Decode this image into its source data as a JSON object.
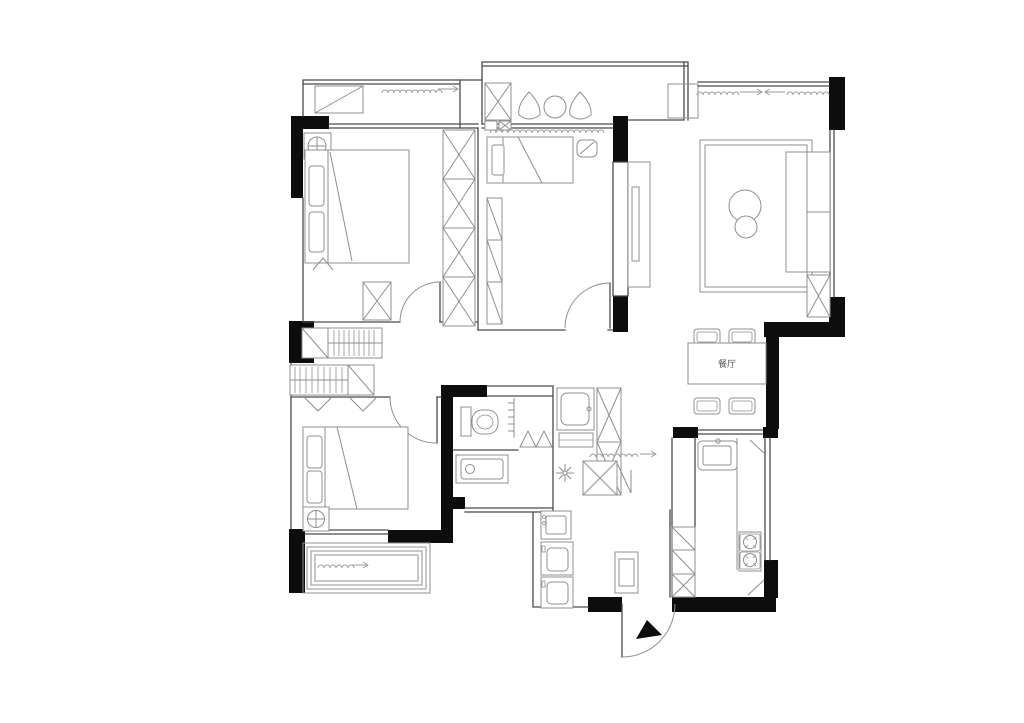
{
  "labels": {
    "dining": "餐厅"
  },
  "colors": {
    "wall": "#0d0d0d",
    "line": "#8f8f8f",
    "structure": "#4a4a4a",
    "label": "#555555",
    "background": "#ffffff"
  },
  "rooms": {
    "dining": {
      "label": "餐厅"
    }
  }
}
